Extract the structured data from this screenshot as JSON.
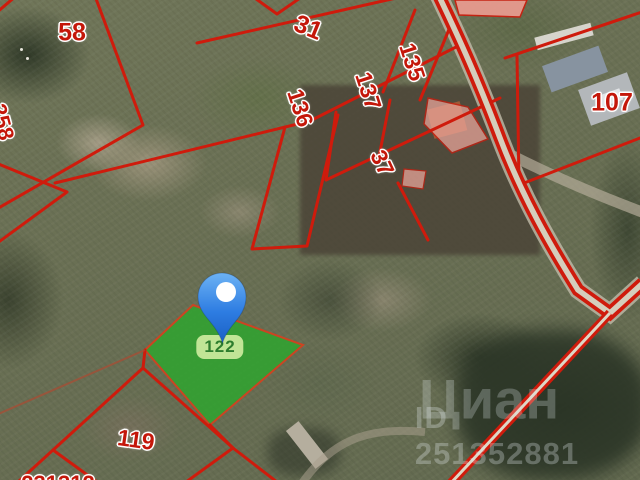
{
  "map": {
    "type": "cadastral-satellite-view",
    "watermark": {
      "brand": "Циан",
      "listing_id": "ID 251352881"
    },
    "selected_parcel": {
      "number": "122"
    },
    "pin": {
      "name": "location-pin"
    },
    "parcel_labels": [
      {
        "number": "58",
        "x": 72,
        "y": 33,
        "rot": 0,
        "size": 25
      },
      {
        "number": "258",
        "x": 2,
        "y": 122,
        "rot": 75,
        "size": 22
      },
      {
        "number": "31",
        "x": 308,
        "y": 28,
        "rot": 22,
        "size": 25
      },
      {
        "number": "135",
        "x": 412,
        "y": 62,
        "rot": 72,
        "size": 23
      },
      {
        "number": "137",
        "x": 368,
        "y": 91,
        "rot": 72,
        "size": 23
      },
      {
        "number": "136",
        "x": 300,
        "y": 108,
        "rot": 72,
        "size": 23
      },
      {
        "number": "37",
        "x": 382,
        "y": 163,
        "rot": 65,
        "size": 23
      },
      {
        "number": "107",
        "x": 612,
        "y": 103,
        "rot": 0,
        "size": 25
      },
      {
        "number": "119",
        "x": 136,
        "y": 440,
        "rot": 8,
        "size": 23
      },
      {
        "number": "231312",
        "x": 58,
        "y": 484,
        "rot": 0,
        "size": 22
      }
    ],
    "colors": {
      "boundary_red": "#cf1b0c",
      "label_red": "#c4170a",
      "selected_green": "#2fa42f",
      "selected_border": "#cc4422",
      "badge_bg": "#cdeb9e",
      "badge_text": "#2e7d2e",
      "pin_blue_top": "#6cb2f4",
      "pin_blue_bottom": "#1a5fc4",
      "road_center": "#d5cebc",
      "watermark_text": "rgba(228,234,238,0.28)"
    }
  }
}
